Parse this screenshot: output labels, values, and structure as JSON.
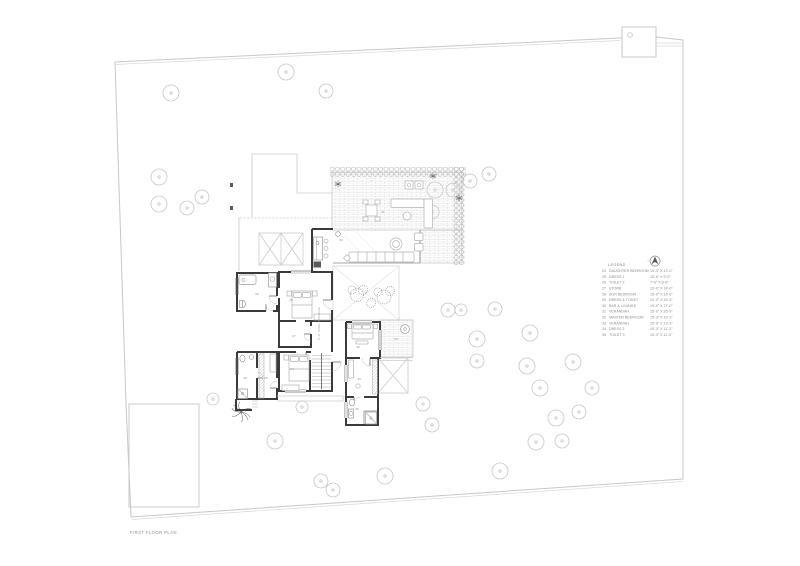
{
  "page": {
    "title": "FIRST FLOOR PLAN"
  },
  "legend": {
    "heading": "LEGEND",
    "items": [
      {
        "no": "24",
        "name": "DAUGHTER BEDROOM",
        "dims": "15'-3\" X 13'-0\""
      },
      {
        "no": "25",
        "name": "DRESS 2",
        "dims": "10'-6\" X 9'-0\""
      },
      {
        "no": "26",
        "name": "TOILET 2",
        "dims": "7'-6\" X 8'-6\""
      },
      {
        "no": "27",
        "name": "STORE",
        "dims": "10'-0\" X 14'-0\""
      },
      {
        "no": "28",
        "name": "SON BEDROOM",
        "dims": "15'-0\" X 16'-6\""
      },
      {
        "no": "29",
        "name": "DRESS & TOILET",
        "dims": "13'-2\" X 16'-9\""
      },
      {
        "no": "30",
        "name": "BAR & LOUNGE",
        "dims": "19'-0\" X 27'-0\""
      },
      {
        "no": "31",
        "name": "VERANDAH",
        "dims": "15'-0\" X 26'-9\""
      },
      {
        "no": "32",
        "name": "MASTER BEDROOM",
        "dims": "15'-3\" X 19'-3\""
      },
      {
        "no": "33",
        "name": "VERANDAH",
        "dims": "15'-9\" X 13'-3\""
      },
      {
        "no": "34",
        "name": "DRESS 3",
        "dims": "15'-3\" X 11'-3\""
      },
      {
        "no": "35",
        "name": "TOILET 3",
        "dims": "10'-3\" X 11'-0\""
      }
    ]
  },
  "plan": {
    "passage_label": "8'-0\" WIDE PASSAGE",
    "room_labels": [
      {
        "no": "29",
        "x": 257,
        "y": 295
      },
      {
        "no": "28",
        "x": 291,
        "y": 301
      },
      {
        "no": "27",
        "x": 294,
        "y": 337
      },
      {
        "no": "24",
        "x": 292,
        "y": 370
      },
      {
        "no": "26",
        "x": 245,
        "y": 379
      },
      {
        "no": "25",
        "x": 266,
        "y": 379
      },
      {
        "no": "30",
        "x": 341,
        "y": 241
      },
      {
        "no": "31",
        "x": 383,
        "y": 213
      },
      {
        "no": "32",
        "x": 358,
        "y": 348
      },
      {
        "no": "33",
        "x": 396,
        "y": 340
      },
      {
        "no": "34",
        "x": 359,
        "y": 380
      },
      {
        "no": "35",
        "x": 357,
        "y": 410
      }
    ],
    "trees": [
      [
        171,
        93,
        8
      ],
      [
        286,
        72,
        8
      ],
      [
        326,
        91,
        7
      ],
      [
        159,
        177,
        8
      ],
      [
        159,
        204,
        8
      ],
      [
        187,
        208,
        7
      ],
      [
        202,
        197,
        7
      ],
      [
        435,
        190,
        8
      ],
      [
        453,
        190,
        7
      ],
      [
        470,
        181,
        7
      ],
      [
        489,
        174,
        7
      ],
      [
        432,
        212,
        7
      ],
      [
        448,
        310,
        7
      ],
      [
        461,
        310,
        6
      ],
      [
        495,
        309,
        7
      ],
      [
        477,
        339,
        8
      ],
      [
        530,
        333,
        8
      ],
      [
        477,
        361,
        7
      ],
      [
        527,
        366,
        8
      ],
      [
        573,
        362,
        8
      ],
      [
        540,
        388,
        8
      ],
      [
        592,
        388,
        7
      ],
      [
        423,
        404,
        7
      ],
      [
        579,
        412,
        7
      ],
      [
        556,
        418,
        8
      ],
      [
        536,
        442,
        8
      ],
      [
        562,
        441,
        7
      ],
      [
        500,
        471,
        8
      ],
      [
        275,
        441,
        8
      ],
      [
        321,
        481,
        7
      ],
      [
        333,
        490,
        7
      ],
      [
        385,
        476,
        8
      ],
      [
        432,
        425,
        7
      ],
      [
        213,
        399,
        6
      ],
      [
        302,
        407,
        6
      ]
    ]
  },
  "colors": {
    "wall": "#3a3a3a",
    "site_line": "#c8c8c8",
    "brick_line": "#d6d6d6",
    "text": "#8b8b8b"
  }
}
